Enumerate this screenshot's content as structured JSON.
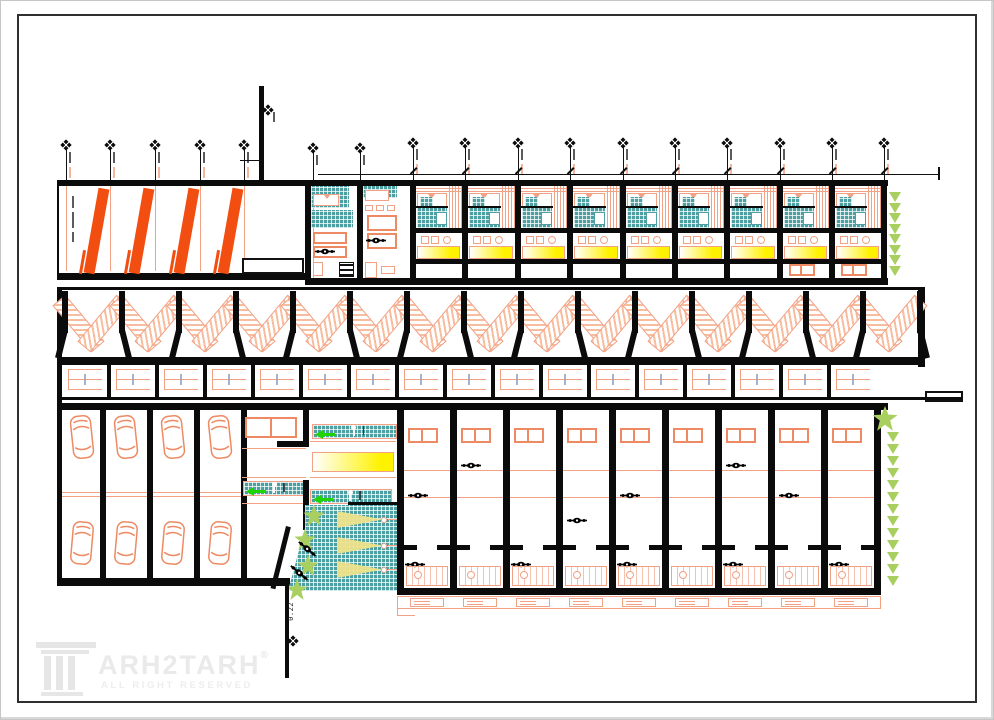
{
  "drawing": {
    "type": "architectural-plan-sheet",
    "title_block": {
      "brand_letters": "ARH2TARH",
      "registered_mark": "®",
      "tagline": "ALL RIGHT RESERVED"
    },
    "elevation_marker": {
      "label": "0.22"
    },
    "colors": {
      "wall": "#0b0b0b",
      "salmon": "#F2A184",
      "salmon_strong": "#ED8A63",
      "ramp_orange": "#F24E11",
      "teal": "#4E9FA1",
      "yellow": "#FFF200",
      "arrow_green": "#1FD400",
      "plant_green": "#A9CF60",
      "cone_yellow": "#EDE38C",
      "squiggle": "#8FA3C0",
      "logo_gray": "#E9E9E9"
    },
    "structure": {
      "left_grid_markers": 5,
      "lobby_grid_markers": 2,
      "bay_grid_markers": 10,
      "ramp_slope_bars": 4,
      "upper_standard_bays": 9,
      "upper_lobby_bays": 2,
      "stair_units": 15,
      "table_cells": 17,
      "parking_stalls": 4,
      "cars_per_stall": 2,
      "right_bays": 9,
      "spotlight_cones": 3,
      "upper_planter_leaves": 8,
      "lower_planter_leaves": 13
    },
    "icons": {
      "grid_marker": "diamond-survey-marker",
      "person": "person-top-view",
      "car": "car-top-view",
      "stair": "stair-flight",
      "arrow": "direction-arrow",
      "plant": "shrub",
      "spotlight": "light-beam-cone",
      "logo": "column-capital"
    }
  }
}
